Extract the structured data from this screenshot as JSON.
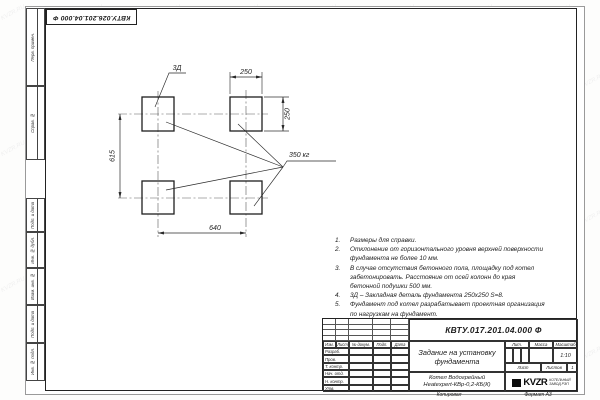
{
  "stamp_top": "КВТУ.026.201.04.000 Ф",
  "watermark": {
    "text": "KVZR.RU"
  },
  "frame": {
    "side_labels": [
      "Перв. примен.",
      "Справ. №",
      "Подп. и дата",
      "Инв. № дубл.",
      "Взам. инв. №",
      "Подп. и дата",
      "Инв. № подл."
    ]
  },
  "drawing": {
    "dims": {
      "pad_width": "250",
      "pad_height": "250",
      "span_vertical": "615",
      "span_horizontal": "640"
    },
    "labels": {
      "embed_detail": "3Д",
      "load": "350 кг"
    }
  },
  "notes": [
    {
      "num": "1.",
      "text": "Размеры для справки."
    },
    {
      "num": "2.",
      "text": "Отклонение от горизонтального уровня верхней поверхности фундамента не более 10 мм."
    },
    {
      "num": "3.",
      "text": "В случае отсутствия бетонного пола, площадку под котел забетонировать. Расстояние от осей колонн до края бетонной подушки 500 мм."
    },
    {
      "num": "4.",
      "text": "3Д – Закладная деталь фундамента 250х250 S=8."
    },
    {
      "num": "5.",
      "text": "Фундамент под котел разрабатывает проектная организация по нагрузкам на фундамент."
    }
  ],
  "titleblock": {
    "doc_number": "КВТУ.017.201.04.000 Ф",
    "title": "Задание на установку фундамента",
    "rev_headers": [
      "Изм.",
      "Лист",
      "№ докум.",
      "Подп.",
      "Дата"
    ],
    "sig_rows": [
      "Разраб.",
      "Пров.",
      "Т. контр.",
      "Нач. отд.",
      "Н. контр.",
      "Утв."
    ],
    "lit_label": "Лит.",
    "mass_label": "Масса",
    "scale_label": "Масштаб",
    "scale_value": "1:10",
    "sheet_label": "Лист",
    "sheets_label": "Листов",
    "sheets_value": "1",
    "product_line1": "Котел Водогрейный",
    "product_line2": "Heatexpert-КВр-0,2-КБ(К)",
    "logo_text": "KVZR",
    "logo_sub1": "КОТЕЛЬНЫЙ",
    "logo_sub2": "ЗАВОД РЭП",
    "footer_copy": "Копировал",
    "footer_format": "Формат А3"
  }
}
